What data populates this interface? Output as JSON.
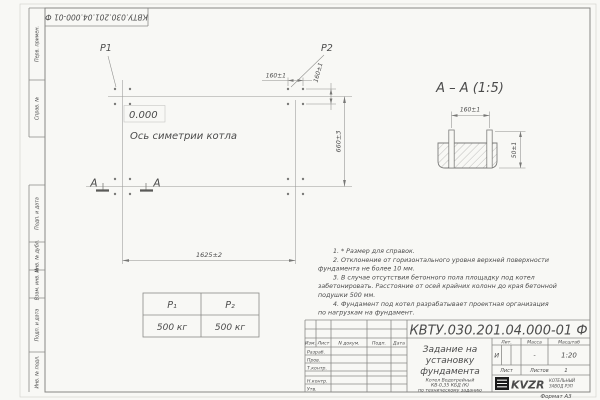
{
  "colors": {
    "paper": "#f8f8f5",
    "line_gray": "#8a8a88",
    "text_gray": "#4b4b4b",
    "logo_black": "#1a1a1a"
  },
  "corner_stamp": {
    "designation": "КВТУ.030.201.04.000-01  Ф"
  },
  "side_strip": {
    "items": [
      {
        "label": "Перв. примен."
      },
      {
        "label": "Справ. №"
      },
      {
        "label": "Подп. и дата"
      },
      {
        "label": "Инв. № дубл."
      },
      {
        "label": "Взам. инв. №"
      },
      {
        "label": "Подп. и дата"
      },
      {
        "label": "Инв. № подл."
      }
    ]
  },
  "plan": {
    "point1_label": "P1",
    "point2_label": "P2",
    "elevation_label": "0.000",
    "axis_label": "Ось симетрии котла",
    "dim_length": "1625±2",
    "dim_width": "660±3",
    "dim_bolt_spacing_h": "160±1",
    "dim_bolt_spacing_v": "160±1",
    "section_letter_left": "А",
    "section_letter_right": "А"
  },
  "section_view": {
    "title": "А – А (1:5)",
    "dim_bolt_spacing": "160±1",
    "dim_embed_depth": "50±1"
  },
  "notes": {
    "lines": [
      {
        "t": "1. * Размер для справок."
      },
      {
        "t": "2. Отклонение от горизонтального уровня верхней поверхности"
      },
      {
        "t": "фундамента не более 10 мм."
      },
      {
        "t": "3. В случае отсутствия бетонного пола площадку под котел"
      },
      {
        "t": "забетонировать. Расстояние от осей крайних колонн до края бетонной"
      },
      {
        "t": "подушки 500 мм."
      },
      {
        "t": "4. Фундамент под котел разрабатывает проектная организация"
      },
      {
        "t": "по нагрузкам на фундамент."
      }
    ]
  },
  "load_table": {
    "col1_header": "P₁",
    "col2_header": "P₂",
    "col1_value": "500 кг",
    "col2_value": "500 кг"
  },
  "title_block": {
    "designation": "КВТУ.030.201.04.000-01  Ф",
    "title_line1": "Задание на",
    "title_line2": "установку",
    "title_line3": "фундамента",
    "product_line1": "Котел Водогрейный",
    "product_line2": "КВ-0,35 КБД (К)",
    "product_line3": "по техническому заданию",
    "col_izm": "Изм.",
    "col_list": "Лист",
    "col_doc": "N докум.",
    "col_sign": "Подп.",
    "col_date": "Дата",
    "row_razrab": "Разраб.",
    "row_prov": "Пров.",
    "row_tkontr": "Т.контр.",
    "row_nkontr": "Н.контр.",
    "row_utv": "Утв.",
    "lit_header": "Лит.",
    "mass_header": "Масса",
    "scale_header": "Масштаб",
    "lit_value": "И",
    "mass_value": "-",
    "scale_value": "1:20",
    "sheet_label": "Лист",
    "sheets_label": "Листов",
    "sheets_value": "1",
    "logo_text": "KVZR",
    "org_line1": "КОТЕЛЬНЫЙ",
    "org_line2": "ЗАВОД РЭП",
    "format_label": "Формат А3"
  }
}
